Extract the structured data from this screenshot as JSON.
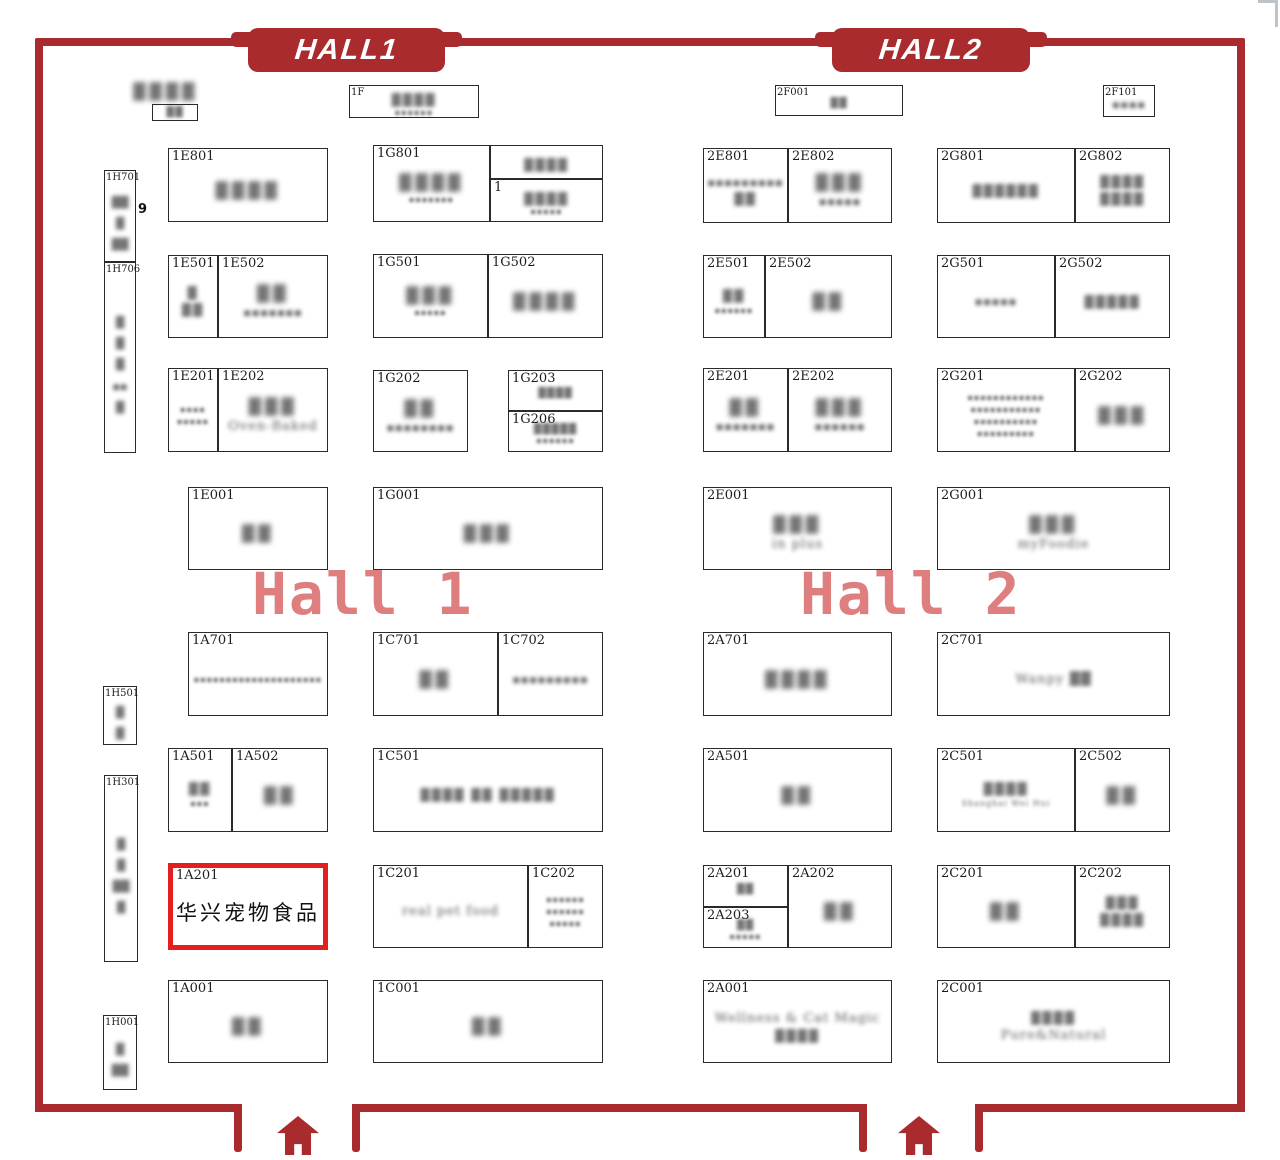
{
  "colors": {
    "wall": "#a92b2e",
    "highlight_border": "#e51f1f",
    "watermark": "#de7e7e",
    "booth_border": "#2a2a2a"
  },
  "banners": {
    "hall1": {
      "label": "HALL1"
    },
    "hall2": {
      "label": "HALL2"
    }
  },
  "watermarks": {
    "hall1": {
      "text": "Hall 1"
    },
    "hall2": {
      "text": "Hall 2"
    }
  },
  "highlighted_booth": {
    "code": "1A201",
    "name": "华兴宠物食品"
  },
  "floating_labels": [
    {
      "text": "▓▓▓▓",
      "x": 133,
      "y": 82,
      "s": "fcjk",
      "name": "blurred-top-label"
    },
    {
      "text": "9",
      "x": 138,
      "y": 202,
      "s": "nine",
      "name": "count-label-9"
    }
  ],
  "booths": [
    {
      "code": "",
      "x": 152,
      "y": 104,
      "w": 46,
      "h": 17,
      "tiny": true,
      "lines": [
        {
          "t": "▓▓",
          "s": "cjk-xs"
        }
      ]
    },
    {
      "code": "1F",
      "x": 349,
      "y": 85,
      "w": 130,
      "h": 33,
      "sc": true,
      "lines": [
        {
          "t": "▓▓▓▓",
          "s": "cjk-sm"
        },
        {
          "t": "▪▪▪▪▪▪",
          "s": "lat"
        }
      ]
    },
    {
      "code": "2F001",
      "x": 775,
      "y": 85,
      "w": 128,
      "h": 31,
      "sc": true,
      "lines": [
        {
          "t": "▓▓",
          "s": "cjk-xs"
        }
      ]
    },
    {
      "code": "2F101",
      "x": 1103,
      "y": 85,
      "w": 52,
      "h": 32,
      "sc": true,
      "lines": [
        {
          "t": "▪▪▪▪",
          "s": "lat-md"
        }
      ]
    },
    {
      "code": "1H701",
      "x": 104,
      "y": 170,
      "w": 32,
      "h": 92,
      "sc": true,
      "vert": true,
      "lines": [
        {
          "t": "▓▓",
          "s": "v"
        },
        {
          "t": "▓",
          "s": "v"
        },
        {
          "t": "▓▓",
          "s": "v"
        }
      ]
    },
    {
      "code": "1H706",
      "x": 104,
      "y": 262,
      "w": 32,
      "h": 191,
      "sc": true,
      "vert": true,
      "lines": [
        {
          "t": "▓",
          "s": "v"
        },
        {
          "t": "▓",
          "s": "v"
        },
        {
          "t": "▓",
          "s": "v"
        },
        {
          "t": "▪▪",
          "s": "v"
        },
        {
          "t": "▓",
          "s": "v"
        }
      ]
    },
    {
      "code": "1H501",
      "x": 103,
      "y": 686,
      "w": 34,
      "h": 59,
      "sc": true,
      "vert": true,
      "lines": [
        {
          "t": "▓",
          "s": "v"
        },
        {
          "t": "▓",
          "s": "v"
        }
      ]
    },
    {
      "code": "1H301",
      "x": 104,
      "y": 775,
      "w": 34,
      "h": 187,
      "sc": true,
      "vert": true,
      "lines": [
        {
          "t": "▓",
          "s": "v"
        },
        {
          "t": "▓",
          "s": "v"
        },
        {
          "t": "▓▓",
          "s": "v"
        },
        {
          "t": "▓",
          "s": "v"
        }
      ]
    },
    {
      "code": "1H001",
      "x": 103,
      "y": 1015,
      "w": 34,
      "h": 75,
      "sc": true,
      "vert": true,
      "lines": [
        {
          "t": "▓",
          "s": "v"
        },
        {
          "t": "▓▓",
          "s": "v"
        }
      ]
    },
    {
      "code": "1E801",
      "x": 168,
      "y": 148,
      "w": 160,
      "h": 74,
      "lines": [
        {
          "t": "▓▓▓▓",
          "s": "cjk"
        }
      ]
    },
    {
      "code": "1G801",
      "x": 373,
      "y": 145,
      "w": 117,
      "h": 77,
      "lines": [
        {
          "t": "▓▓▓▓",
          "s": "cjk"
        },
        {
          "t": "▪▪▪▪▪▪▪",
          "s": "lat"
        }
      ]
    },
    {
      "code": "",
      "x": 490,
      "y": 145,
      "w": 113,
      "h": 34,
      "lines": [
        {
          "t": "▓▓▓▓",
          "s": "cjk-sm"
        }
      ]
    },
    {
      "code": "1",
      "x": 490,
      "y": 179,
      "w": 113,
      "h": 43,
      "lines": [
        {
          "t": "▓▓▓▓",
          "s": "cjk-sm"
        },
        {
          "t": "▪▪▪▪▪",
          "s": "lat"
        }
      ]
    },
    {
      "code": "1E501",
      "x": 168,
      "y": 255,
      "w": 50,
      "h": 83,
      "lines": [
        {
          "t": "▓",
          "s": "cjk-sm"
        },
        {
          "t": "▓▓",
          "s": "cjk-sm"
        }
      ]
    },
    {
      "code": "1E502",
      "x": 218,
      "y": 255,
      "w": 110,
      "h": 83,
      "lines": [
        {
          "t": "▓▓",
          "s": "cjk"
        },
        {
          "t": "▪▪▪▪▪▪▪",
          "s": "lat-md"
        }
      ]
    },
    {
      "code": "1G501",
      "x": 373,
      "y": 254,
      "w": 115,
      "h": 84,
      "lines": [
        {
          "t": "▓▓▓",
          "s": "cjk"
        },
        {
          "t": "▪▪▪▪▪",
          "s": "lat"
        }
      ]
    },
    {
      "code": "1G502",
      "x": 488,
      "y": 254,
      "w": 115,
      "h": 84,
      "lines": [
        {
          "t": "▓▓▓▓",
          "s": "cjk"
        }
      ]
    },
    {
      "code": "1E201",
      "x": 168,
      "y": 368,
      "w": 50,
      "h": 84,
      "lines": [
        {
          "t": "▪▪▪▪",
          "s": "lat"
        },
        {
          "t": "▪▪▪▪▪",
          "s": "lat"
        }
      ]
    },
    {
      "code": "1E202",
      "x": 218,
      "y": 368,
      "w": 110,
      "h": 84,
      "lines": [
        {
          "t": "▓▓▓",
          "s": "cjk"
        },
        {
          "t": "Oven-Baked",
          "s": "lat-lg"
        }
      ]
    },
    {
      "code": "1G202",
      "x": 373,
      "y": 370,
      "w": 95,
      "h": 82,
      "lines": [
        {
          "t": "▓▓",
          "s": "cjk"
        },
        {
          "t": "▪▪▪▪▪▪▪▪",
          "s": "lat-md"
        }
      ]
    },
    {
      "code": "1G203",
      "x": 508,
      "y": 370,
      "w": 95,
      "h": 41,
      "lines": [
        {
          "t": "▓▓▓▓",
          "s": "cjk-xs"
        }
      ]
    },
    {
      "code": "1G206",
      "x": 508,
      "y": 411,
      "w": 95,
      "h": 41,
      "lines": [
        {
          "t": "▓▓▓▓▓",
          "s": "cjk-xs"
        },
        {
          "t": "▪▪▪▪▪▪",
          "s": "lat"
        }
      ]
    },
    {
      "code": "1E001",
      "x": 188,
      "y": 487,
      "w": 140,
      "h": 83,
      "lines": [
        {
          "t": "▓▓",
          "s": "cjk"
        }
      ]
    },
    {
      "code": "1G001",
      "x": 373,
      "y": 487,
      "w": 230,
      "h": 83,
      "lines": [
        {
          "t": "▓▓▓",
          "s": "cjk"
        }
      ]
    },
    {
      "code": "1A701",
      "x": 188,
      "y": 632,
      "w": 140,
      "h": 84,
      "lines": [
        {
          "t": "▪▪▪▪▪▪▪▪▪▪▪▪▪▪▪▪▪▪▪▪",
          "s": "lat"
        }
      ]
    },
    {
      "code": "1C701",
      "x": 373,
      "y": 632,
      "w": 125,
      "h": 84,
      "lines": [
        {
          "t": "▓▓",
          "s": "cjk"
        }
      ]
    },
    {
      "code": "1C702",
      "x": 498,
      "y": 632,
      "w": 105,
      "h": 84,
      "lines": [
        {
          "t": "▪▪▪▪▪▪▪▪▪",
          "s": "lat-md"
        }
      ]
    },
    {
      "code": "1A501",
      "x": 168,
      "y": 748,
      "w": 64,
      "h": 84,
      "lines": [
        {
          "t": "▓▓",
          "s": "cjk-sm"
        },
        {
          "t": "▪▪▪",
          "s": "lat"
        }
      ]
    },
    {
      "code": "1A502",
      "x": 232,
      "y": 748,
      "w": 96,
      "h": 84,
      "lines": [
        {
          "t": "▓▓",
          "s": "cjk"
        }
      ]
    },
    {
      "code": "1C501",
      "x": 373,
      "y": 748,
      "w": 230,
      "h": 84,
      "lines": [
        {
          "t": "▓▓▓▓ ▓▓ ▓▓▓▓▓",
          "s": "cjk-sm"
        }
      ]
    },
    {
      "code": "1A201",
      "x": 168,
      "y": 863,
      "w": 160,
      "h": 87,
      "hl": true,
      "lines": [
        {
          "t": "华兴宠物食品",
          "s": "clear"
        }
      ]
    },
    {
      "code": "1C201",
      "x": 373,
      "y": 865,
      "w": 155,
      "h": 83,
      "lines": [
        {
          "t": "real pet food",
          "s": "lat-lg"
        }
      ]
    },
    {
      "code": "1C202",
      "x": 528,
      "y": 865,
      "w": 75,
      "h": 83,
      "lines": [
        {
          "t": "▪▪▪▪▪▪",
          "s": "lat"
        },
        {
          "t": "▪▪▪▪▪▪",
          "s": "lat"
        },
        {
          "t": "▪▪▪▪▪",
          "s": "lat"
        }
      ]
    },
    {
      "code": "1A001",
      "x": 168,
      "y": 980,
      "w": 160,
      "h": 83,
      "lines": [
        {
          "t": "▓▓",
          "s": "cjk"
        }
      ]
    },
    {
      "code": "1C001",
      "x": 373,
      "y": 980,
      "w": 230,
      "h": 83,
      "lines": [
        {
          "t": "▓▓",
          "s": "cjk"
        }
      ]
    },
    {
      "code": "2E801",
      "x": 703,
      "y": 148,
      "w": 85,
      "h": 75,
      "lines": [
        {
          "t": "▪▪▪▪▪▪▪▪▪",
          "s": "lat-md"
        },
        {
          "t": "▓▓",
          "s": "cjk-sm"
        }
      ]
    },
    {
      "code": "2E802",
      "x": 788,
      "y": 148,
      "w": 104,
      "h": 75,
      "lines": [
        {
          "t": "▓▓▓",
          "s": "cjk"
        },
        {
          "t": "▪▪▪▪▪",
          "s": "lat-md"
        }
      ]
    },
    {
      "code": "2G801",
      "x": 937,
      "y": 148,
      "w": 138,
      "h": 75,
      "lines": [
        {
          "t": "▓▓▓▓▓▓",
          "s": "cjk-sm"
        }
      ]
    },
    {
      "code": "2G802",
      "x": 1075,
      "y": 148,
      "w": 95,
      "h": 75,
      "lines": [
        {
          "t": "▓▓▓▓",
          "s": "cjk-sm"
        },
        {
          "t": "▓▓▓▓",
          "s": "cjk-sm"
        }
      ]
    },
    {
      "code": "2E501",
      "x": 703,
      "y": 255,
      "w": 62,
      "h": 83,
      "lines": [
        {
          "t": "▓▓",
          "s": "cjk-sm"
        },
        {
          "t": "▪▪▪▪▪▪",
          "s": "lat"
        }
      ]
    },
    {
      "code": "2E502",
      "x": 765,
      "y": 255,
      "w": 127,
      "h": 83,
      "lines": [
        {
          "t": "▓▓",
          "s": "cjk"
        }
      ]
    },
    {
      "code": "2G501",
      "x": 937,
      "y": 255,
      "w": 118,
      "h": 83,
      "lines": [
        {
          "t": "▪▪▪▪▪",
          "s": "lat-md"
        }
      ]
    },
    {
      "code": "2G502",
      "x": 1055,
      "y": 255,
      "w": 115,
      "h": 83,
      "lines": [
        {
          "t": "▓▓▓▓▓",
          "s": "cjk-sm"
        }
      ]
    },
    {
      "code": "2E201",
      "x": 703,
      "y": 368,
      "w": 85,
      "h": 84,
      "lines": [
        {
          "t": "▓▓",
          "s": "cjk"
        },
        {
          "t": "▪▪▪▪▪▪▪",
          "s": "lat-md"
        }
      ]
    },
    {
      "code": "2E202",
      "x": 788,
      "y": 368,
      "w": 104,
      "h": 84,
      "lines": [
        {
          "t": "▓▓▓",
          "s": "cjk"
        },
        {
          "t": "▪▪▪▪▪▪",
          "s": "lat-md"
        }
      ]
    },
    {
      "code": "2G201",
      "x": 937,
      "y": 368,
      "w": 138,
      "h": 84,
      "lines": [
        {
          "t": "▪▪▪▪▪▪▪▪▪▪▪▪",
          "s": "lat"
        },
        {
          "t": "▪▪▪▪▪▪▪▪▪▪▪",
          "s": "lat"
        },
        {
          "t": "▪▪▪▪▪▪▪▪▪▪",
          "s": "lat"
        },
        {
          "t": "▪▪▪▪▪▪▪▪▪",
          "s": "lat"
        }
      ]
    },
    {
      "code": "2G202",
      "x": 1075,
      "y": 368,
      "w": 95,
      "h": 84,
      "lines": [
        {
          "t": "▓▓▓",
          "s": "cjk"
        }
      ]
    },
    {
      "code": "2E001",
      "x": 703,
      "y": 487,
      "w": 189,
      "h": 83,
      "lines": [
        {
          "t": "▓▓▓",
          "s": "cjk"
        },
        {
          "t": "in plus",
          "s": "lat-lg"
        }
      ]
    },
    {
      "code": "2G001",
      "x": 937,
      "y": 487,
      "w": 233,
      "h": 83,
      "lines": [
        {
          "t": "▓▓▓",
          "s": "cjk"
        },
        {
          "t": "myFoodie",
          "s": "lat-lg"
        }
      ]
    },
    {
      "code": "2A701",
      "x": 703,
      "y": 632,
      "w": 189,
      "h": 84,
      "lines": [
        {
          "t": "▓▓▓▓",
          "s": "cjk"
        }
      ]
    },
    {
      "code": "2C701",
      "x": 937,
      "y": 632,
      "w": 233,
      "h": 84,
      "lines": [
        {
          "t": "Wanpy ▓▓",
          "s": "lat-lg"
        }
      ]
    },
    {
      "code": "2A501",
      "x": 703,
      "y": 748,
      "w": 189,
      "h": 84,
      "lines": [
        {
          "t": "▓▓",
          "s": "cjk"
        }
      ]
    },
    {
      "code": "2C501",
      "x": 937,
      "y": 748,
      "w": 138,
      "h": 84,
      "lines": [
        {
          "t": "▓▓▓▓",
          "s": "cjk-sm"
        },
        {
          "t": "Shanghai Wei Hui",
          "s": "lat"
        }
      ]
    },
    {
      "code": "2C502",
      "x": 1075,
      "y": 748,
      "w": 95,
      "h": 84,
      "lines": [
        {
          "t": "▓▓",
          "s": "cjk"
        }
      ]
    },
    {
      "code": "2A201",
      "x": 703,
      "y": 865,
      "w": 85,
      "h": 42,
      "lines": [
        {
          "t": "▓▓",
          "s": "cjk-xs"
        }
      ]
    },
    {
      "code": "2A203",
      "x": 703,
      "y": 907,
      "w": 85,
      "h": 41,
      "lines": [
        {
          "t": "▓▓",
          "s": "cjk-xs"
        },
        {
          "t": "▪▪▪▪▪",
          "s": "lat"
        }
      ]
    },
    {
      "code": "2A202",
      "x": 788,
      "y": 865,
      "w": 104,
      "h": 83,
      "lines": [
        {
          "t": "▓▓",
          "s": "cjk"
        }
      ]
    },
    {
      "code": "2C201",
      "x": 937,
      "y": 865,
      "w": 138,
      "h": 83,
      "lines": [
        {
          "t": "▓▓",
          "s": "cjk"
        }
      ]
    },
    {
      "code": "2C202",
      "x": 1075,
      "y": 865,
      "w": 95,
      "h": 83,
      "lines": [
        {
          "t": "▓▓▓",
          "s": "cjk-sm"
        },
        {
          "t": "▓▓▓▓",
          "s": "cjk-sm"
        }
      ]
    },
    {
      "code": "2A001",
      "x": 703,
      "y": 980,
      "w": 189,
      "h": 83,
      "lines": [
        {
          "t": "Wellness & Cat Magic",
          "s": "lat-lg"
        },
        {
          "t": "▓▓▓▓",
          "s": "cjk-sm"
        }
      ]
    },
    {
      "code": "2C001",
      "x": 937,
      "y": 980,
      "w": 233,
      "h": 83,
      "lines": [
        {
          "t": "▓▓▓▓",
          "s": "cjk-sm"
        },
        {
          "t": "Pure&Natural",
          "s": "lat-lg"
        }
      ]
    }
  ],
  "structure": {
    "bottom_wall_segments": [
      {
        "x": 35,
        "width": 207,
        "hook_end": "right"
      },
      {
        "x": 352,
        "width": 515,
        "hook_end": "both"
      },
      {
        "x": 975,
        "width": 270,
        "hook_end": "left"
      }
    ],
    "entrance_arrows": [
      {
        "x": 277,
        "y": 1116
      },
      {
        "x": 898,
        "y": 1116
      }
    ]
  }
}
